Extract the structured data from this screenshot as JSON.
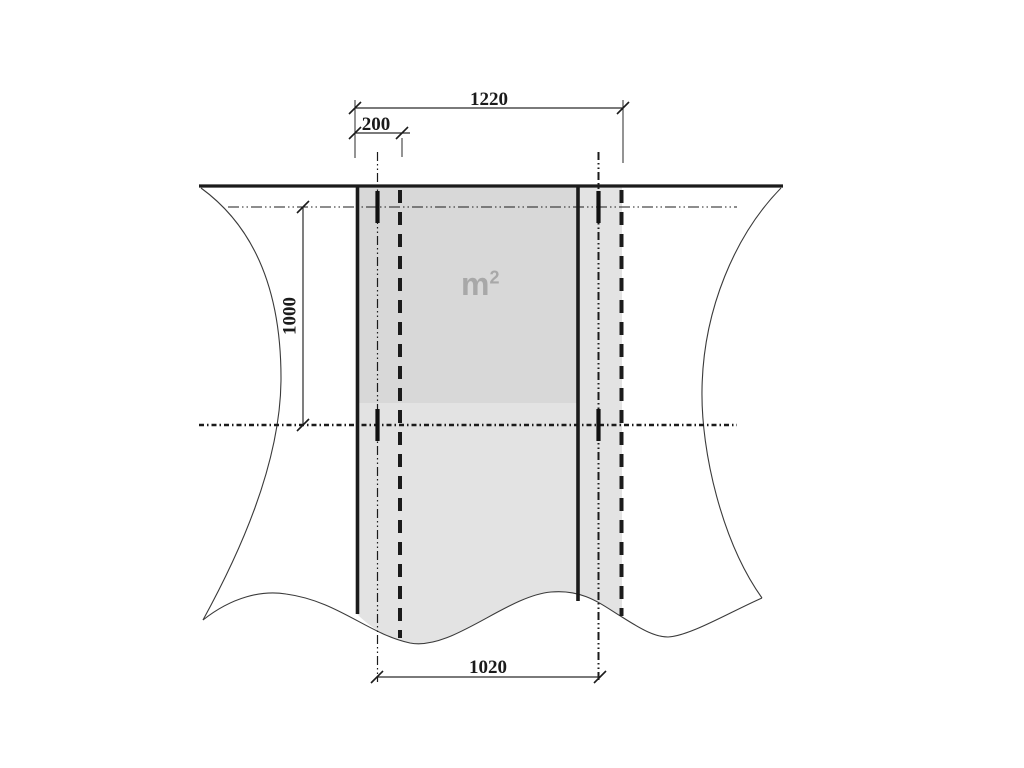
{
  "drawing": {
    "kind": "sheet-overlap-technical-drawing",
    "dimension_labels": {
      "total_width": "1220",
      "overlap": "200",
      "length": "1000",
      "cover_width": "1020"
    },
    "area_label": {
      "base": "m",
      "exponent": "2"
    },
    "colors": {
      "background": "#ffffff",
      "line": "#1b1b1b",
      "thin_line": "#3a3a3a",
      "sheet_fill": "#e3e3e3",
      "area_highlight_fill": "#d8d8d8",
      "area_text": "#a8a8a8"
    }
  }
}
